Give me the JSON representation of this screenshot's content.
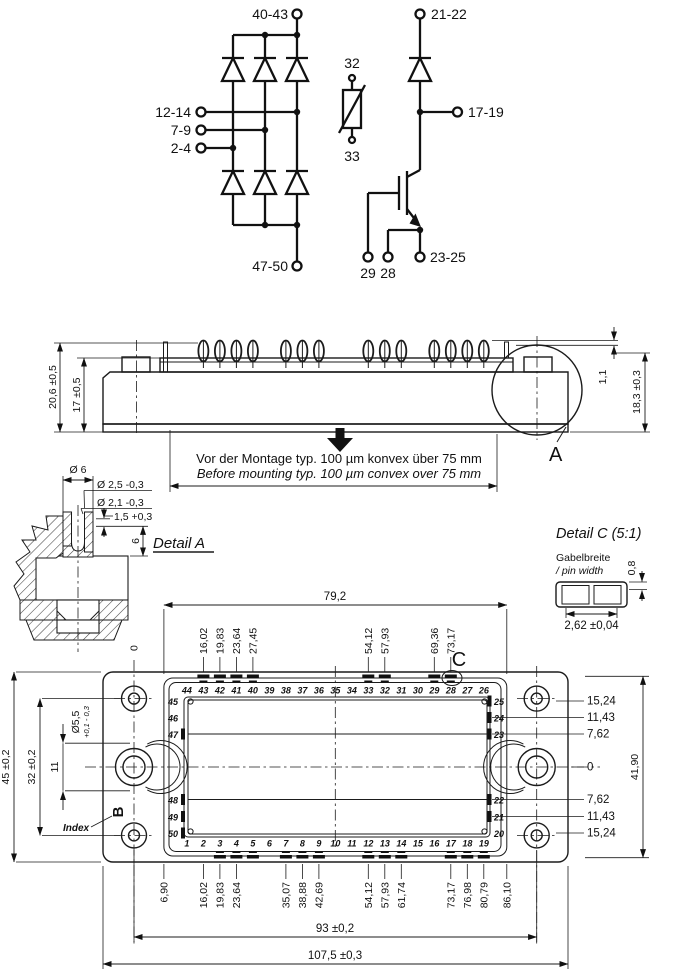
{
  "schematic": {
    "t40_43": "40-43",
    "t21_22": "21-22",
    "t12_14": "12-14",
    "t7_9": "7-9",
    "t2_4": "2-4",
    "t47_50": "47-50",
    "t17_19": "17-19",
    "t23_25": "23-25",
    "t32": "32",
    "t33": "33",
    "t29": "29",
    "t28": "28"
  },
  "side_view": {
    "dim_outer": "20,6 ±0,5",
    "dim_inner": "17 ±0,5",
    "dim_pin": "1,1",
    "dim_body": "18,3 ±0,3",
    "detail_label": "A",
    "note_de": "Vor der Montage typ. 100 µm konvex über 75 mm",
    "note_en": "Before mounting typ. 100 µm convex over 75 mm"
  },
  "detail_a": {
    "title": "Detail A",
    "dia6": "Ø 6",
    "dia25": "Ø 2,5 -0,3",
    "dia21": "Ø 2,1 -0,3",
    "lip": "1,5 +0,3",
    "depth": "6"
  },
  "detail_c": {
    "title": "Detail C (5:1)",
    "label_de": "Gabelbreite",
    "label_en": "/ pin width",
    "height": "0,8",
    "width": "2,62 ±0,04"
  },
  "top_view": {
    "width_pins": "79,2",
    "zero": "0",
    "c_label": "C",
    "top_dims": [
      "16,02",
      "19,83",
      "23,64",
      "27,45",
      "54,12",
      "57,93",
      "69,36",
      "73,17"
    ],
    "bottom_dims": [
      "6,90",
      "16,02",
      "19,83",
      "23,64",
      "35,07",
      "38,88",
      "42,69",
      "54,12",
      "57,93",
      "61,74",
      "73,17",
      "76,98",
      "80,79",
      "86,10"
    ],
    "right_dims": [
      "15,24",
      "11,43",
      "7,62",
      "0",
      "7,62",
      "11,43",
      "15,24"
    ],
    "pins_top": [
      "44",
      "43",
      "42",
      "41",
      "40",
      "39",
      "38",
      "37",
      "36",
      "35",
      "34",
      "33",
      "32",
      "31",
      "30",
      "29",
      "28",
      "27",
      "26"
    ],
    "pins_bottom": [
      "1",
      "2",
      "3",
      "4",
      "5",
      "6",
      "7",
      "8",
      "9",
      "10",
      "11",
      "12",
      "13",
      "14",
      "15",
      "16",
      "17",
      "18",
      "19"
    ],
    "pins_left": [
      "45",
      "46",
      "47",
      "48",
      "49",
      "50"
    ],
    "pins_right": [
      "25",
      "24",
      "23",
      "22",
      "21",
      "20"
    ],
    "height_total": "41,90",
    "height_outer": "45 ±0,2",
    "height_holes": "32 ±0,2",
    "slot": "11",
    "hole_dia": "Ø5,5",
    "hole_tol": "+0,1 - 0,3",
    "width_holes": "93 ±0,2",
    "width_total": "107,5 ±0,3",
    "index_label": "Index",
    "index_mark": "B"
  }
}
